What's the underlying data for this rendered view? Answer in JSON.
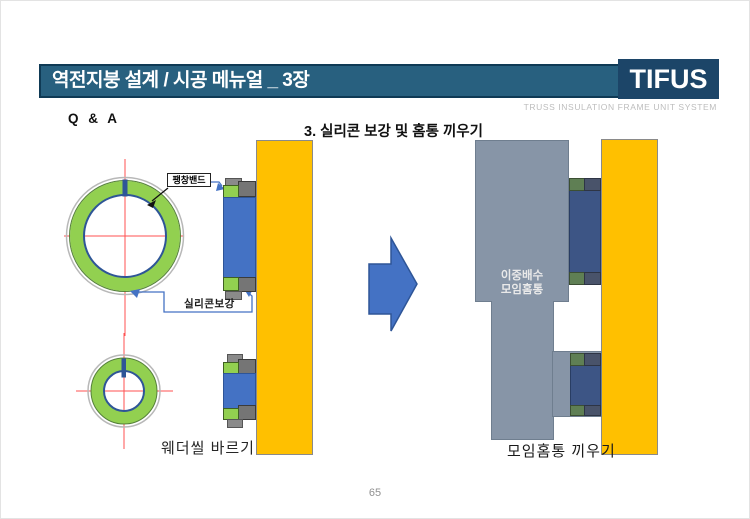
{
  "header": {
    "title": "역전지붕 설계 / 시공 메뉴얼 _ 3장",
    "logo": "TIFUS",
    "tagline": "TRUSS INSULATION FRAME UNIT SYSTEM"
  },
  "page": {
    "qa_label": "Q & A",
    "section_heading": "3. 실리콘 보강 및 홈통 끼우기",
    "page_number": "65"
  },
  "left_diagram": {
    "label_expansion_band": "팽창밴드",
    "label_silicone": "실리콘보강",
    "caption": "웨더씰 바르기"
  },
  "right_diagram": {
    "gutter_line1": "이중배수",
    "gutter_line2": "모임홈통",
    "caption": "모임홈통 끼우기"
  },
  "colors": {
    "header_bar": "#28607F",
    "header_border": "#0F3A55",
    "logo_bg": "#1C4568",
    "yellow": "#FFC000",
    "blue": "#4472C4",
    "blue_border": "#2E5597",
    "green": "#92D050",
    "gutter_gray": "#8795A7",
    "muted_blue": "#3D5585",
    "muted_green": "#5F7F54",
    "muted_gray": "#49536A",
    "crosshair_red": "#FF5050"
  }
}
